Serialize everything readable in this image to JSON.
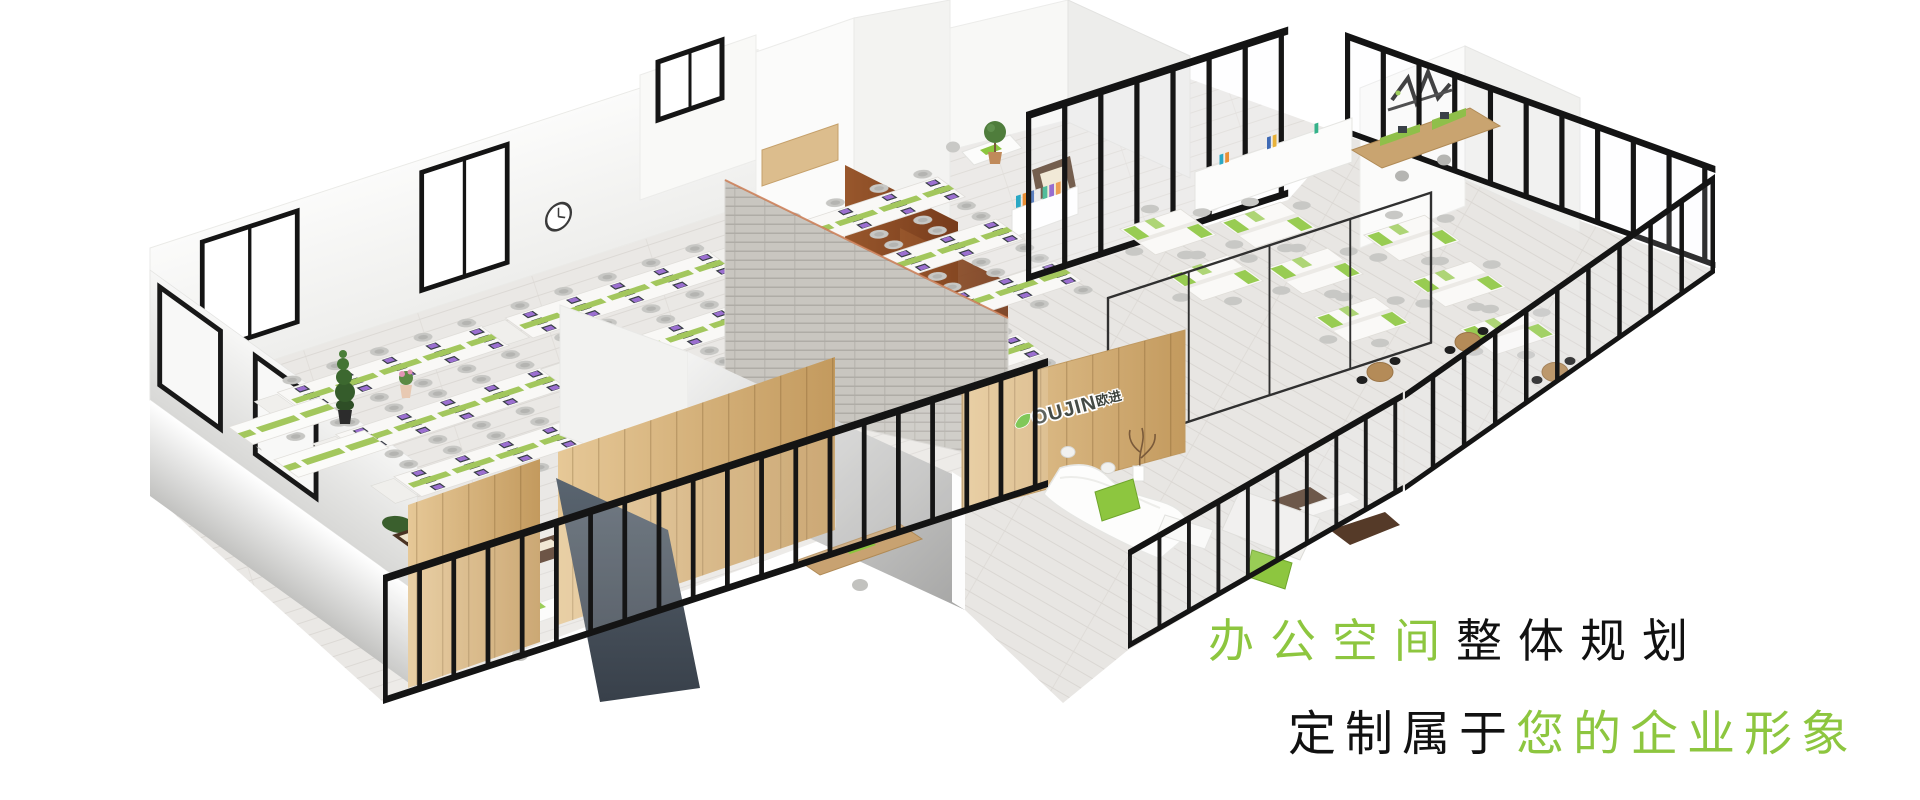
{
  "page": {
    "aria_label": "3D isometric cutaway rendering of a complete office floor plan with open workstation rows, glass partitioned offices, meeting rooms, reception with logo wall and lounge areas"
  },
  "headline": {
    "line1": {
      "segments": [
        {
          "text": "办公空间",
          "color_role": "accent"
        },
        {
          "text": "整体规划",
          "color_role": "ink"
        }
      ]
    },
    "line2": {
      "segments": [
        {
          "text": "定制属于",
          "color_role": "ink"
        },
        {
          "text": "您的企业形象",
          "color_role": "accent"
        }
      ]
    }
  },
  "logo": {
    "latin": "OUJIN",
    "cjk": "欧进"
  },
  "colors": {
    "accent_green": "#8dc63f",
    "ink_black": "#111111",
    "frame_black": "#161616",
    "wood_light": "#d5b07c",
    "wood_dark": "#82431f",
    "slate_blue": "#49525e",
    "silver": "#b5b5b5",
    "floor_grey": "#e9e7e4",
    "sofa_brown": "#553a28",
    "booth_brown": "#4a3323",
    "leaf_green": "#6cbf3e"
  }
}
